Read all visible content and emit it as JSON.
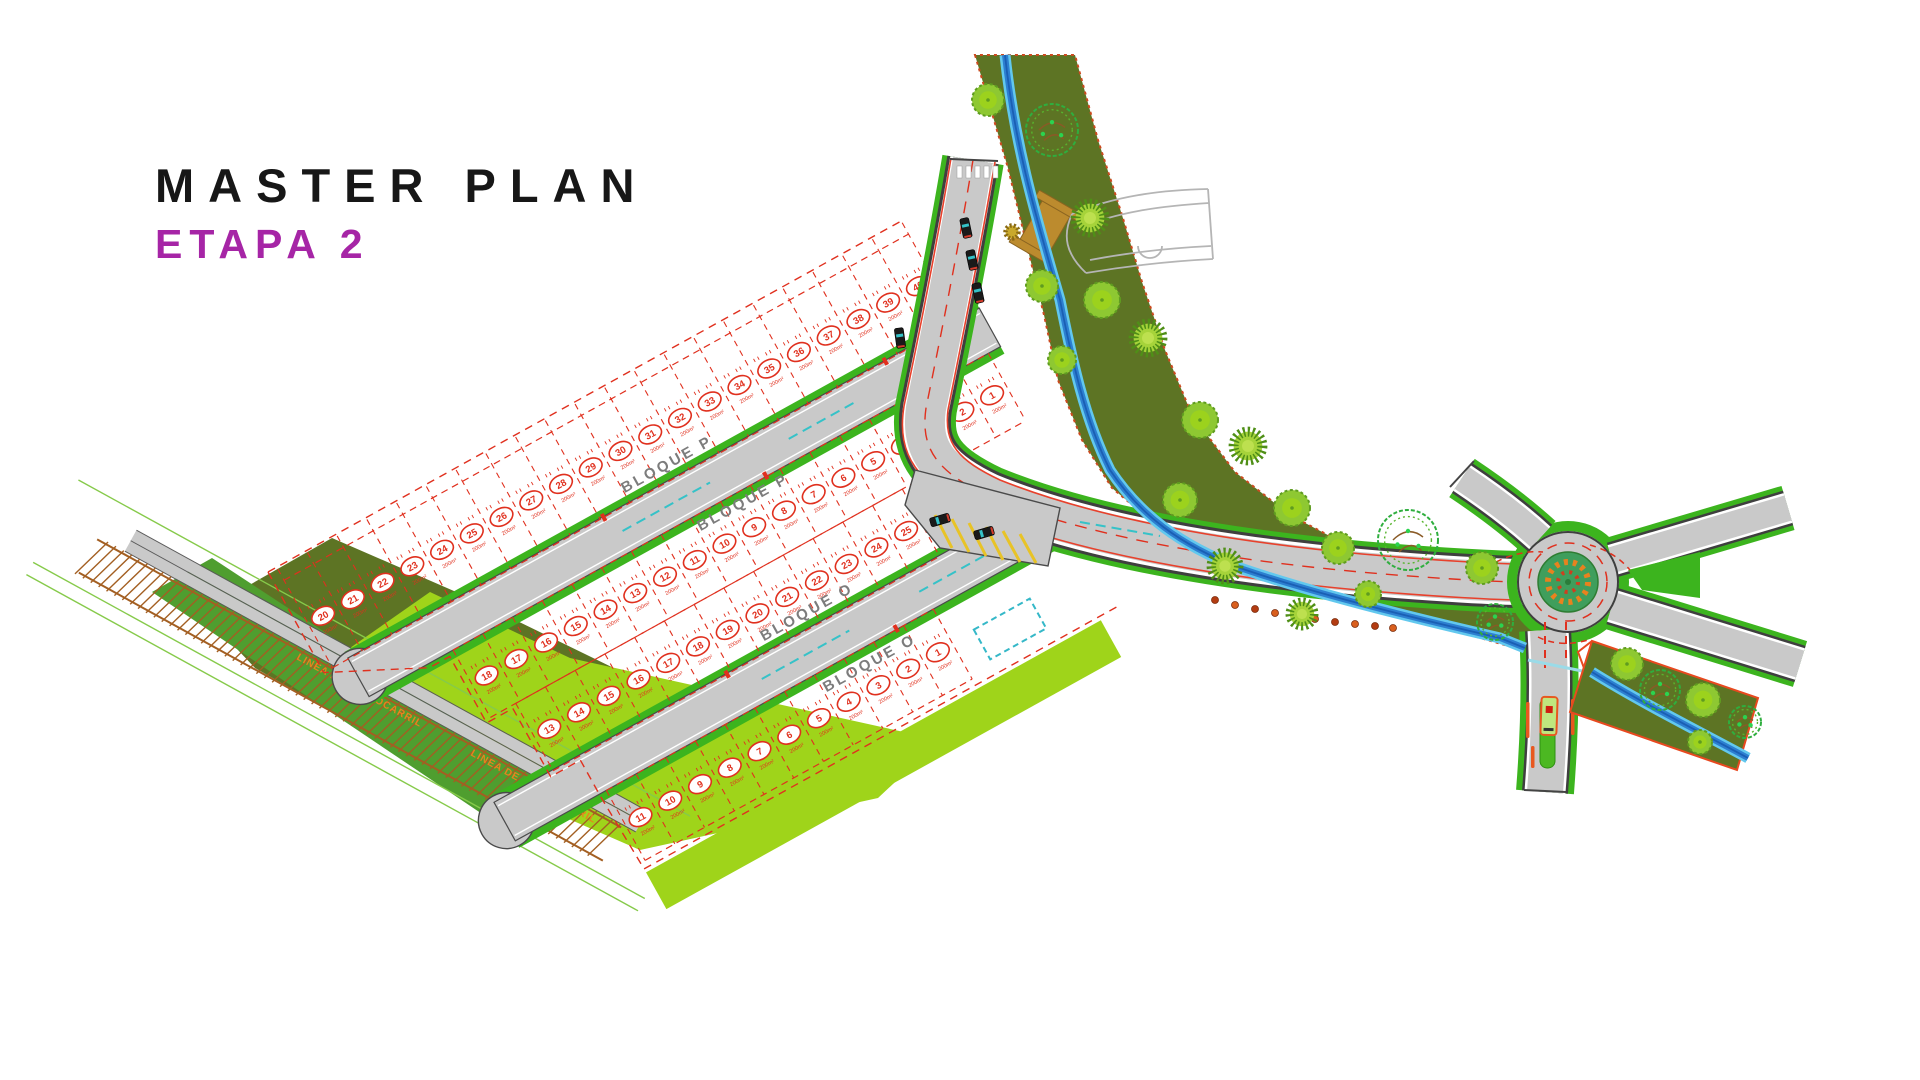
{
  "title": {
    "line1": "MASTER PLAN",
    "line2": "ETAPA 2"
  },
  "colors": {
    "title_accent": "#a625a6",
    "lot_red": "#e0301e",
    "road_gray": "#c9c9c9",
    "road_edge": "#3f3f3f",
    "verge_green": "#3cb41e",
    "lawn_chartreuse": "#9fd41a",
    "lawn_medium": "#4f9e2f",
    "corridor_olive": "#5d7424",
    "corridor_border": "#cc4a1f",
    "stream_blue": "#2d7fd0",
    "stream_light": "#62c8ee",
    "railway_brown": "#a35f22",
    "rail_label_orange": "#e8821e",
    "tree_green": "#8ec832",
    "cyan_marking": "#35c2c8",
    "yellow_hatch": "#e8c326",
    "bridge_tan": "#bc8b2e",
    "bus_orange": "#e8581f"
  },
  "plan": {
    "labels": {
      "bloque_p": "BLOQUE P",
      "bloque_o": "BLOQUE O"
    },
    "railway_label": "LINEA DE FERROCARRIL",
    "lot_area_label": "200m²",
    "lot_rows": [
      {
        "id": "row-a",
        "x0": 10,
        "y": 15,
        "depth": 100,
        "cell_w": 34,
        "numbers": [
          20,
          21,
          22,
          23,
          24,
          25,
          26,
          27,
          28,
          29,
          30,
          31,
          32,
          33,
          34,
          35,
          36,
          37,
          38,
          39,
          40
        ]
      },
      {
        "id": "row-b",
        "x0": 124,
        "y": 158,
        "depth": 77,
        "cell_w": 34,
        "numbers": [
          18,
          17,
          16,
          15,
          14,
          13,
          12,
          11,
          10,
          9,
          8,
          7,
          6,
          5,
          4,
          3,
          2,
          1
        ]
      },
      {
        "id": "row-c",
        "x0": 153,
        "y": 235,
        "depth": 77,
        "cell_w": 34,
        "numbers": [
          13,
          14,
          15,
          16,
          17,
          18,
          19,
          20,
          21,
          22,
          23,
          24,
          25
        ]
      },
      {
        "id": "row-d",
        "x0": 190,
        "y": 355,
        "depth": 80,
        "cell_w": 34,
        "numbers": [
          11,
          10,
          9,
          8,
          7,
          6,
          5,
          4,
          3,
          2,
          1
        ]
      }
    ],
    "railway": {
      "x1": 88,
      "y1": 556,
      "x2": 612,
      "y2": 844,
      "label_positions": [
        {
          "x": 296,
          "y": 659
        },
        {
          "x": 470,
          "y": 755
        }
      ]
    },
    "roundabout": {
      "cx": 1568,
      "cy": 582
    },
    "trees": [
      {
        "x": 988,
        "y": 100,
        "r": 16,
        "kind": "fluffy"
      },
      {
        "x": 1052,
        "y": 130,
        "r": 26,
        "kind": "scribble"
      },
      {
        "x": 1012,
        "y": 232,
        "r": 9,
        "kind": "orange"
      },
      {
        "x": 1090,
        "y": 218,
        "r": 20,
        "kind": "spiky"
      },
      {
        "x": 1042,
        "y": 286,
        "r": 16,
        "kind": "fluffy"
      },
      {
        "x": 1102,
        "y": 300,
        "r": 18,
        "kind": "fluffy"
      },
      {
        "x": 1148,
        "y": 338,
        "r": 20,
        "kind": "spiky"
      },
      {
        "x": 1062,
        "y": 360,
        "r": 14,
        "kind": "fluffy"
      },
      {
        "x": 1200,
        "y": 420,
        "r": 18,
        "kind": "fluffy"
      },
      {
        "x": 1248,
        "y": 446,
        "r": 20,
        "kind": "spiky"
      },
      {
        "x": 1180,
        "y": 500,
        "r": 17,
        "kind": "fluffy"
      },
      {
        "x": 1292,
        "y": 508,
        "r": 18,
        "kind": "fluffy"
      },
      {
        "x": 1225,
        "y": 566,
        "r": 19,
        "kind": "spiky"
      },
      {
        "x": 1338,
        "y": 548,
        "r": 16,
        "kind": "fluffy"
      },
      {
        "x": 1408,
        "y": 540,
        "r": 30,
        "kind": "scribble"
      },
      {
        "x": 1482,
        "y": 568,
        "r": 16,
        "kind": "fluffy"
      },
      {
        "x": 1302,
        "y": 614,
        "r": 17,
        "kind": "spiky"
      },
      {
        "x": 1368,
        "y": 594,
        "r": 13,
        "kind": "fluffy"
      },
      {
        "x": 1495,
        "y": 622,
        "r": 18,
        "kind": "scribble"
      },
      {
        "x": 1627,
        "y": 664,
        "r": 16,
        "kind": "fluffy"
      },
      {
        "x": 1660,
        "y": 690,
        "r": 20,
        "kind": "scribble"
      },
      {
        "x": 1703,
        "y": 700,
        "r": 17,
        "kind": "fluffy"
      },
      {
        "x": 1745,
        "y": 722,
        "r": 16,
        "kind": "scribble"
      },
      {
        "x": 1700,
        "y": 742,
        "r": 12,
        "kind": "fluffy"
      }
    ],
    "shrubs": [
      [
        1215,
        600
      ],
      [
        1235,
        605
      ],
      [
        1255,
        609
      ],
      [
        1275,
        613
      ],
      [
        1295,
        616
      ],
      [
        1315,
        619
      ],
      [
        1335,
        622
      ],
      [
        1355,
        624
      ],
      [
        1375,
        626
      ],
      [
        1393,
        628
      ]
    ],
    "cars": [
      {
        "x": 966,
        "y": 228,
        "angle": 78
      },
      {
        "x": 972,
        "y": 260,
        "angle": 78
      },
      {
        "x": 978,
        "y": 293,
        "angle": 78
      },
      {
        "x": 900,
        "y": 338,
        "angle": 82
      },
      {
        "x": 940,
        "y": 520,
        "angle": -16
      },
      {
        "x": 984,
        "y": 533,
        "angle": -16
      }
    ],
    "bus": {
      "x": 1549,
      "y": 716,
      "angle": 2
    }
  }
}
